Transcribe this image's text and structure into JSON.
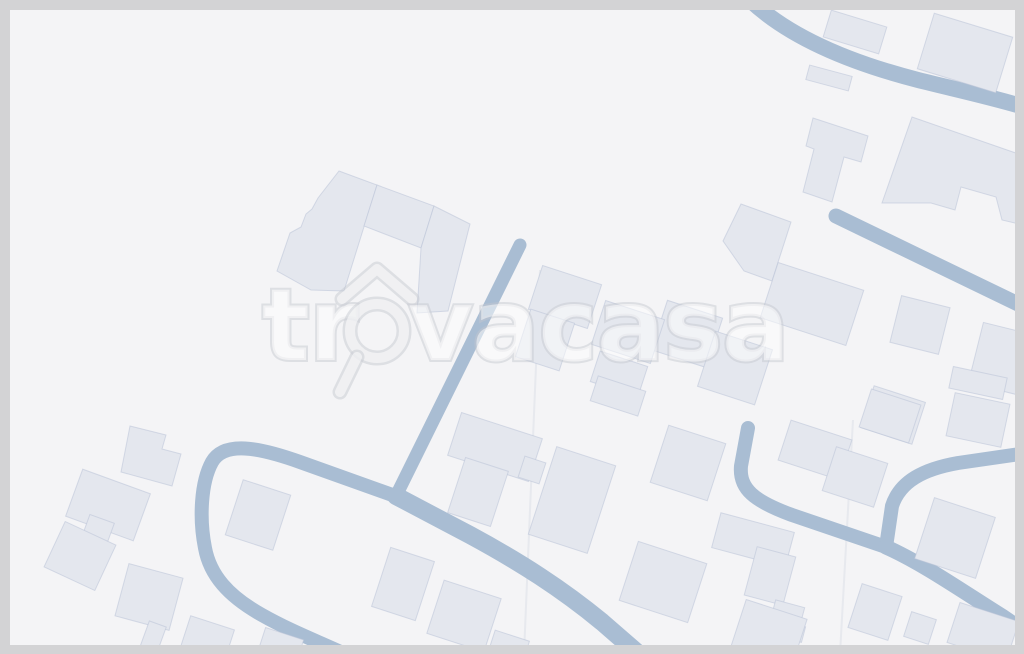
{
  "meta": {
    "description": "Watermarked aerial map of a residential area",
    "brand": "trovacasa"
  },
  "frame": {
    "color": "#d3d3d5",
    "top": 10,
    "left": 10,
    "right": 9,
    "bottom": 9
  },
  "map": {
    "background": "#f4f4f6",
    "building_fill": "#e4e7ee",
    "building_stroke": "rgba(185,195,215,0.55)",
    "road_color": "#a9bdd3",
    "parcel_line_color": "rgba(205,211,223,0.35)",
    "roads": [
      {
        "name": "road-top-right-curve",
        "d": "M 750 0 C 788 36 848 62 918 80 C 958 90 1000 99 1034 110",
        "w": 16
      },
      {
        "name": "road-diagonal-upper-right",
        "d": "M 836 216 L 1018 304",
        "w": 15
      },
      {
        "name": "road-vertical-center",
        "d": "M 520 245 L 396 496",
        "w": 13
      },
      {
        "name": "road-loop-left",
        "d": "M 398 497 L 300 462 C 258 447 224 441 212 462 C 201 482 199 518 205 548 C 210 575 228 596 262 615 C 292 632 322 643 358 660",
        "w": 14
      },
      {
        "name": "road-main-diagonal",
        "d": "M 396 496 L 470 535 C 520 562 562 589 602 622 L 648 662",
        "w": 18
      },
      {
        "name": "road-culdesac",
        "d": "M 748 428 L 741 466 C 739 489 754 501 792 515 L 886 547",
        "w": 14
      },
      {
        "name": "road-right-branch",
        "d": "M 1034 452 L 958 463 C 924 469 900 481 892 506 L 886 547",
        "w": 14
      },
      {
        "name": "road-bottom-right",
        "d": "M 886 547 C 922 563 962 591 1002 616 L 1040 642",
        "w": 15
      }
    ],
    "parcel_lines": [
      {
        "x1": 540,
        "y1": 270,
        "x2": 524,
        "y2": 654
      },
      {
        "x1": 853,
        "y1": 420,
        "x2": 840,
        "y2": 654
      }
    ],
    "buildings_poly": [
      {
        "name": "building-complex-left-wing",
        "points": "339,171 377,185 344,291 311,290 277,271 290,233 301,227 306,214 312,209 318,198"
      },
      {
        "name": "building-complex-middle",
        "points": "377,185 434,206 421,248 364,226"
      },
      {
        "name": "building-complex-right-wing",
        "points": "434,206 470,224 448,311 417,313 421,248"
      },
      {
        "name": "building-t-shape",
        "points": "813,118 868,136 861,162 844,157 832,202 803,192 814,149 806,146"
      },
      {
        "name": "building-large-slab",
        "points": "912,117 1036,160 1036,228 1002,220 996,197 961,187 955,210 931,203 882,203"
      },
      {
        "name": "building-pentagon",
        "points": "741,204 791,222 772,281 744,271 723,241"
      },
      {
        "name": "building-house-notched",
        "points": "130,426 166,435 162,449 181,454 172,486 121,472"
      }
    ],
    "buildings_rect": [
      {
        "cx": 855,
        "cy": 32,
        "w": 58,
        "h": 28,
        "a": 17
      },
      {
        "cx": 965,
        "cy": 53,
        "w": 82,
        "h": 58,
        "a": 17
      },
      {
        "cx": 829,
        "cy": 78,
        "w": 44,
        "h": 15,
        "a": 15
      },
      {
        "cx": 812,
        "cy": 304,
        "w": 90,
        "h": 58,
        "a": 18
      },
      {
        "cx": 920,
        "cy": 325,
        "w": 50,
        "h": 48,
        "a": 14
      },
      {
        "cx": 687,
        "cy": 334,
        "w": 58,
        "h": 52,
        "a": 18
      },
      {
        "cx": 735,
        "cy": 368,
        "w": 60,
        "h": 58,
        "a": 18
      },
      {
        "cx": 1006,
        "cy": 360,
        "w": 62,
        "h": 62,
        "a": 14
      },
      {
        "cx": 978,
        "cy": 383,
        "w": 55,
        "h": 22,
        "a": 12
      },
      {
        "cx": 978,
        "cy": 420,
        "w": 56,
        "h": 44,
        "a": 12
      },
      {
        "cx": 893,
        "cy": 415,
        "w": 54,
        "h": 44,
        "a": 18
      },
      {
        "cx": 565,
        "cy": 297,
        "w": 62,
        "h": 46,
        "a": 18
      },
      {
        "cx": 545,
        "cy": 340,
        "w": 46,
        "h": 50,
        "a": 18
      },
      {
        "cx": 628,
        "cy": 332,
        "w": 62,
        "h": 46,
        "a": 18
      },
      {
        "cx": 619,
        "cy": 374,
        "w": 50,
        "h": 32,
        "a": 18
      },
      {
        "cx": 618,
        "cy": 396,
        "w": 50,
        "h": 26,
        "a": 18
      },
      {
        "cx": 108,
        "cy": 505,
        "w": 72,
        "h": 50,
        "a": 20
      },
      {
        "cx": 97,
        "cy": 533,
        "w": 26,
        "h": 30,
        "a": 20
      },
      {
        "cx": 80,
        "cy": 556,
        "w": 56,
        "h": 50,
        "a": 25
      },
      {
        "cx": 149,
        "cy": 597,
        "w": 56,
        "h": 54,
        "a": 15
      },
      {
        "cx": 152,
        "cy": 640,
        "w": 18,
        "h": 34,
        "a": 20
      },
      {
        "cx": 207,
        "cy": 640,
        "w": 46,
        "h": 36,
        "a": 18
      },
      {
        "cx": 280,
        "cy": 648,
        "w": 40,
        "h": 30,
        "a": 18
      },
      {
        "cx": 258,
        "cy": 515,
        "w": 50,
        "h": 58,
        "a": 18
      },
      {
        "cx": 495,
        "cy": 447,
        "w": 85,
        "h": 45,
        "a": 18
      },
      {
        "cx": 478,
        "cy": 492,
        "w": 45,
        "h": 58,
        "a": 18
      },
      {
        "cx": 532,
        "cy": 470,
        "w": 22,
        "h": 22,
        "a": 18
      },
      {
        "cx": 572,
        "cy": 500,
        "w": 62,
        "h": 92,
        "a": 18
      },
      {
        "cx": 403,
        "cy": 584,
        "w": 46,
        "h": 62,
        "a": 18
      },
      {
        "cx": 464,
        "cy": 616,
        "w": 60,
        "h": 56,
        "a": 18
      },
      {
        "cx": 508,
        "cy": 649,
        "w": 36,
        "h": 28,
        "a": 18
      },
      {
        "cx": 688,
        "cy": 463,
        "w": 60,
        "h": 60,
        "a": 18
      },
      {
        "cx": 663,
        "cy": 582,
        "w": 72,
        "h": 62,
        "a": 18
      },
      {
        "cx": 753,
        "cy": 540,
        "w": 76,
        "h": 36,
        "a": 15
      },
      {
        "cx": 770,
        "cy": 576,
        "w": 40,
        "h": 50,
        "a": 15
      },
      {
        "cx": 788,
        "cy": 612,
        "w": 30,
        "h": 17,
        "a": 15
      },
      {
        "cx": 790,
        "cy": 631,
        "w": 28,
        "h": 16,
        "a": 15
      },
      {
        "cx": 768,
        "cy": 636,
        "w": 64,
        "h": 56,
        "a": 18
      },
      {
        "cx": 815,
        "cy": 450,
        "w": 64,
        "h": 42,
        "a": 18
      },
      {
        "cx": 855,
        "cy": 477,
        "w": 54,
        "h": 46,
        "a": 18
      },
      {
        "cx": 890,
        "cy": 416,
        "w": 52,
        "h": 40,
        "a": 18
      },
      {
        "cx": 955,
        "cy": 538,
        "w": 64,
        "h": 64,
        "a": 18
      },
      {
        "cx": 875,
        "cy": 612,
        "w": 42,
        "h": 46,
        "a": 18
      },
      {
        "cx": 920,
        "cy": 628,
        "w": 26,
        "h": 26,
        "a": 18
      },
      {
        "cx": 983,
        "cy": 632,
        "w": 62,
        "h": 42,
        "a": 18
      }
    ]
  },
  "watermark": {
    "text": "trovacasa",
    "prefix": "tr",
    "suffix": "vacasa",
    "fill": "rgba(255,255,255,0.58)",
    "outline": "rgba(195,199,205,0.55)",
    "font_size": 100,
    "baseline_y": 360,
    "prefix_x": 262,
    "suffix_x": 408,
    "group_opacity": 0.85,
    "glass": {
      "cx": 377,
      "cy": 331,
      "r": 27,
      "ring_width": 10,
      "roof_points": "342,299 377,269 412,299",
      "handle": {
        "x1": 357,
        "y1": 357,
        "x2": 340,
        "y2": 392
      }
    }
  }
}
